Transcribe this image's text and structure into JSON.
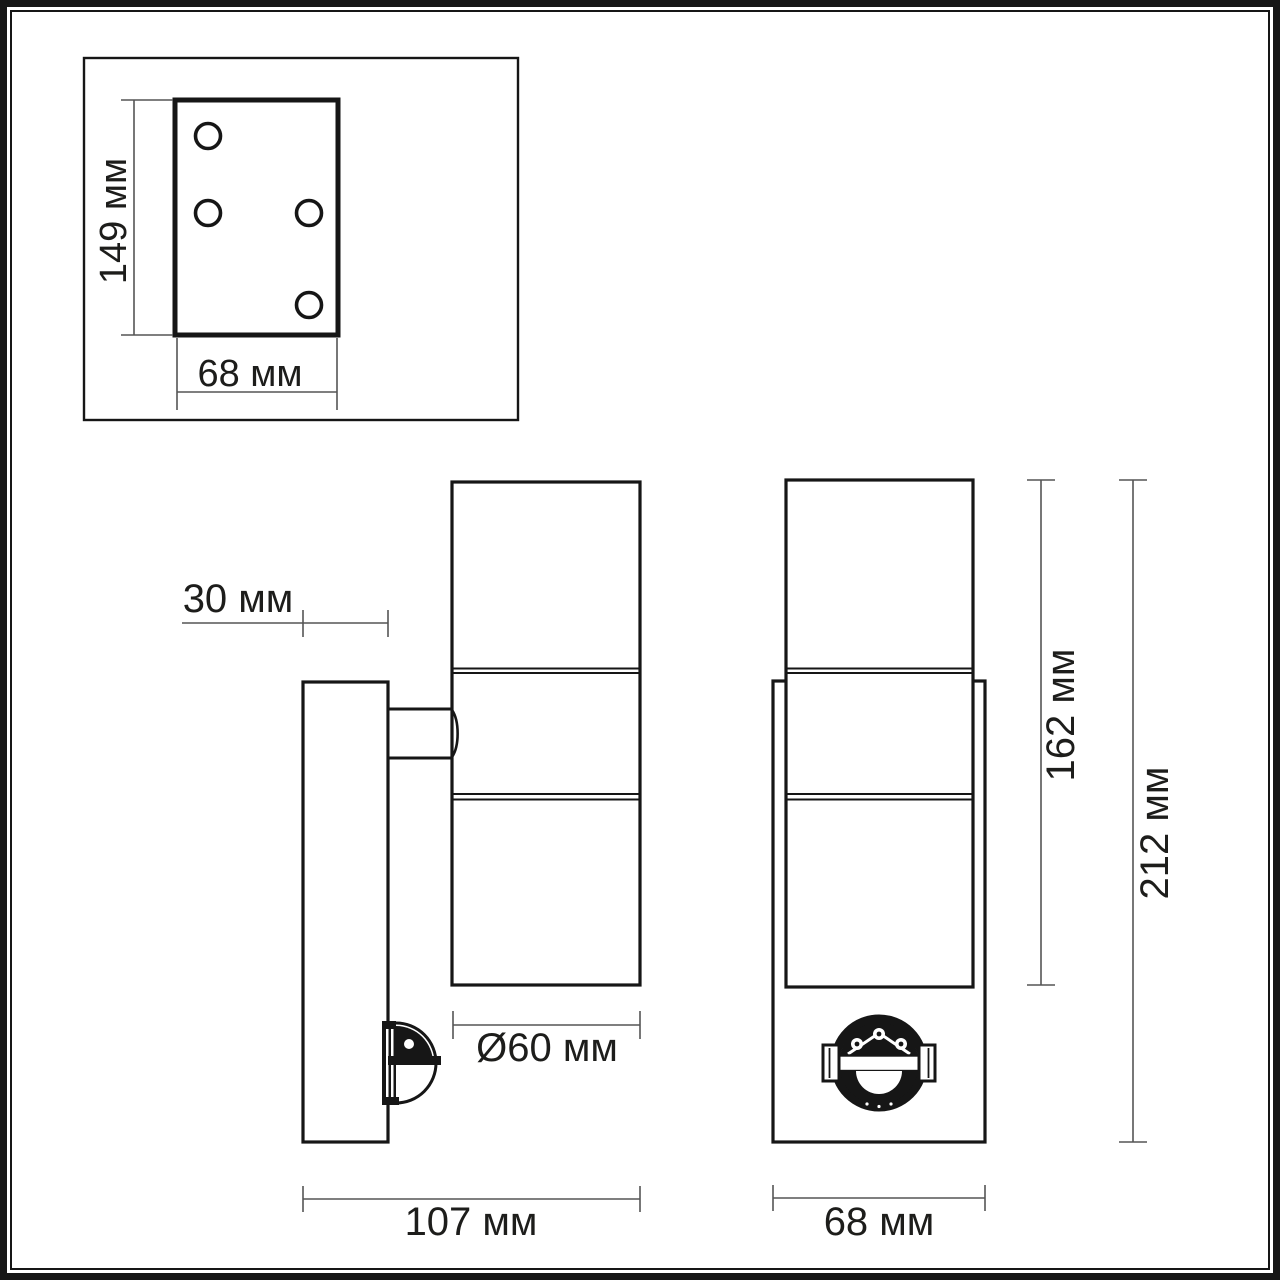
{
  "views": {
    "mounting_plate": {
      "height_label": "149 мм",
      "width_label": "68 мм"
    },
    "side": {
      "wall_offset_label": "30 мм",
      "diameter_label": "Ø60 мм",
      "depth_label": "107 мм"
    },
    "front": {
      "body_height_label": "162 мм",
      "overall_height_label": "212 мм",
      "width_label": "68 мм"
    }
  },
  "colors": {
    "background": "#ffffff",
    "outline": "#161616",
    "dimension": "#555555",
    "text": "#1d1d1b"
  }
}
